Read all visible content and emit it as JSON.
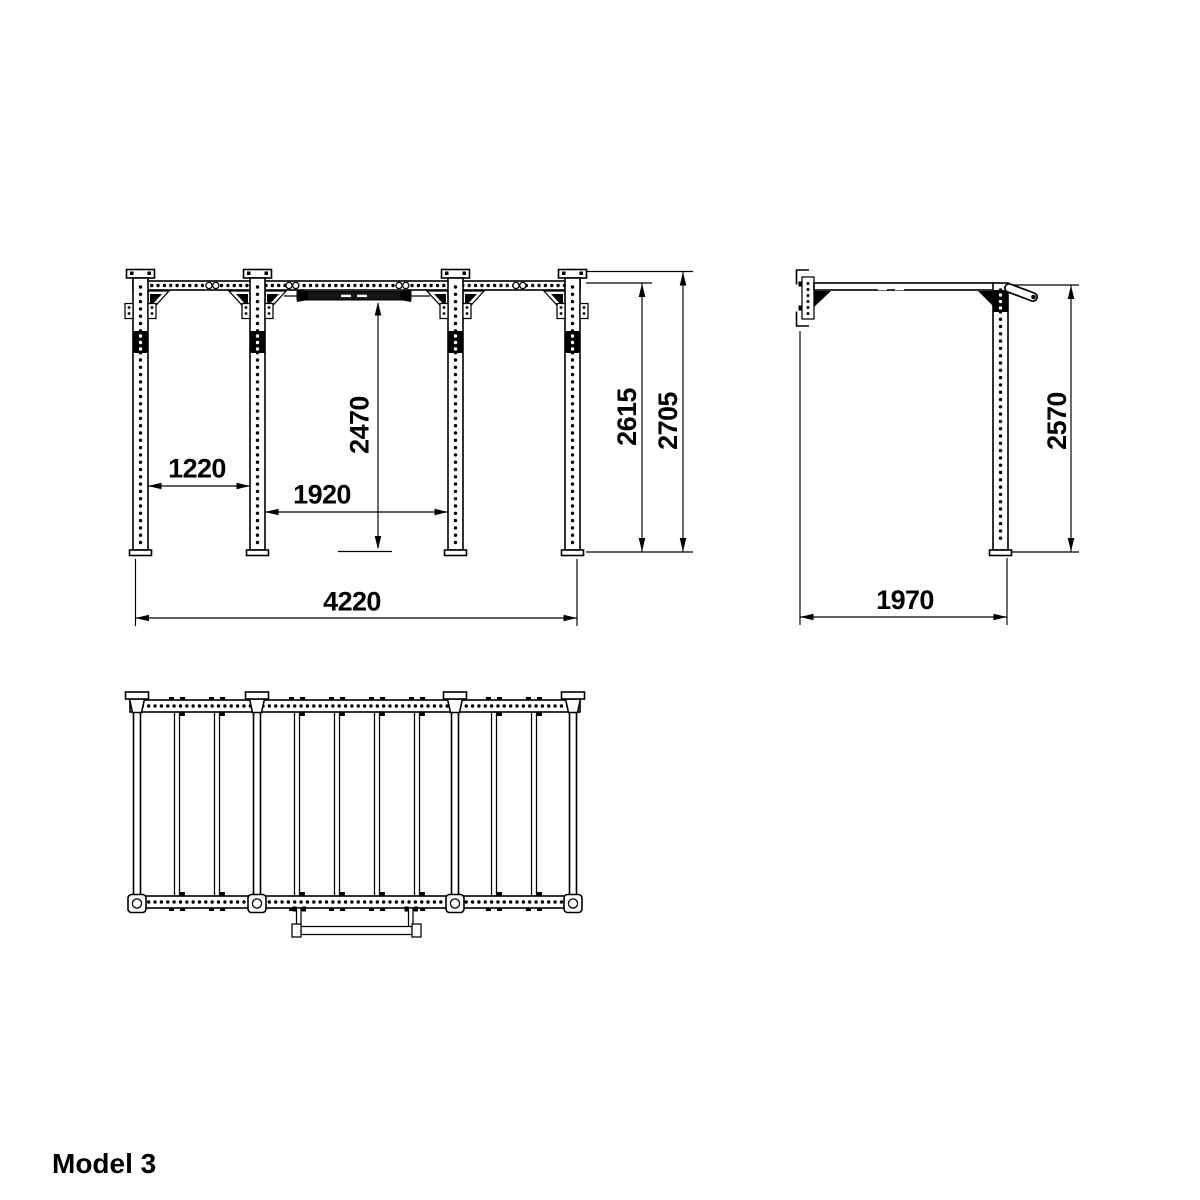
{
  "drawing": {
    "model_label": "Model 3",
    "front_view": {
      "bay1_width_mm": "1220",
      "bay2_width_mm": "1920",
      "pullup_bar_height_mm": "2470",
      "frame_height_mm": "2615",
      "total_height_mm": "2705",
      "total_width_mm": "4220"
    },
    "side_view": {
      "post_height_mm": "2570",
      "depth_mm": "1970"
    }
  }
}
